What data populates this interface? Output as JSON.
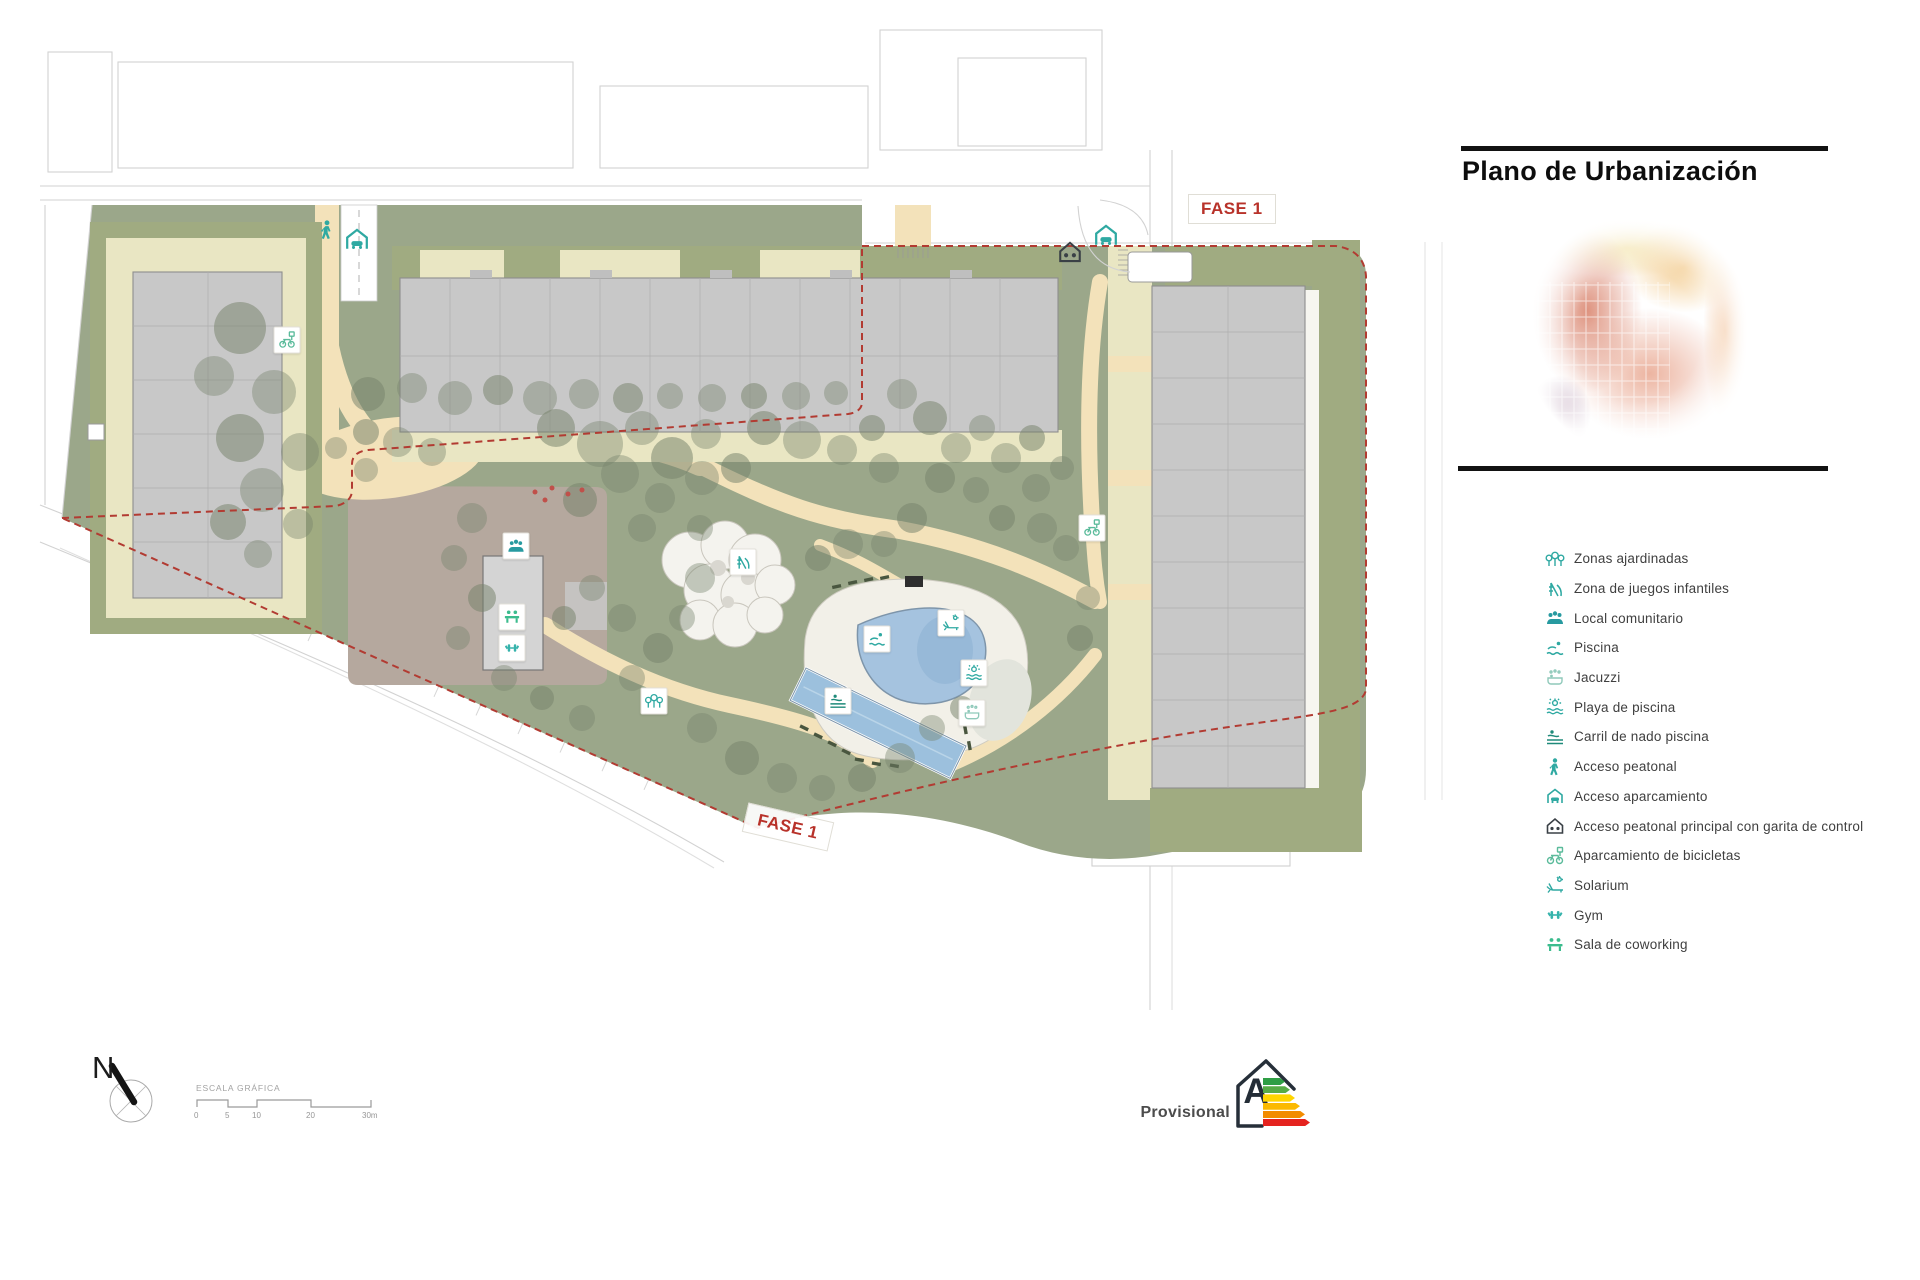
{
  "header": {
    "title": "Plano de Urbanización"
  },
  "plan": {
    "phase_labels": [
      {
        "text": "FASE 1"
      },
      {
        "text": "FASE 1"
      }
    ],
    "markers": [
      {
        "icon": "pedestrian-icon",
        "x": 327,
        "y": 230,
        "boxed": false,
        "size": 22,
        "color": "#2fa9a2"
      },
      {
        "icon": "parking-access-icon",
        "x": 357,
        "y": 239,
        "boxed": false,
        "size": 28,
        "color": "#2fa9a2"
      },
      {
        "icon": "main-access-icon",
        "x": 1070,
        "y": 252,
        "boxed": false,
        "size": 26,
        "color": "#3a4046"
      },
      {
        "icon": "parking-access-icon",
        "x": 1106,
        "y": 235,
        "boxed": false,
        "size": 28,
        "color": "#2fa9a2"
      },
      {
        "icon": "bike-parking-icon",
        "x": 287,
        "y": 340,
        "boxed": true,
        "size": 19,
        "color": "#5bbb9b"
      },
      {
        "icon": "community-icon",
        "x": 516,
        "y": 546,
        "boxed": true,
        "size": 19,
        "color": "#279aa0"
      },
      {
        "icon": "coworking-icon",
        "x": 512,
        "y": 617,
        "boxed": true,
        "size": 19,
        "color": "#3cbc8e"
      },
      {
        "icon": "gym-icon",
        "x": 512,
        "y": 648,
        "boxed": true,
        "size": 19,
        "color": "#36b3ac"
      },
      {
        "icon": "playground-icon",
        "x": 743,
        "y": 562,
        "boxed": true,
        "size": 19,
        "color": "#2fa9a2"
      },
      {
        "icon": "trees-icon",
        "x": 654,
        "y": 701,
        "boxed": true,
        "size": 19,
        "color": "#2fa9a2"
      },
      {
        "icon": "pool-icon",
        "x": 877,
        "y": 639,
        "boxed": true,
        "size": 19,
        "color": "#2fa9a2"
      },
      {
        "icon": "solarium-icon",
        "x": 951,
        "y": 623,
        "boxed": true,
        "size": 19,
        "color": "#2fa9a2"
      },
      {
        "icon": "pool-beach-icon",
        "x": 974,
        "y": 673,
        "boxed": true,
        "size": 19,
        "color": "#2fa9a2"
      },
      {
        "icon": "jacuzzi-icon",
        "x": 972,
        "y": 713,
        "boxed": true,
        "size": 19,
        "color": "#8fc9ba"
      },
      {
        "icon": "swim-lane-icon",
        "x": 838,
        "y": 701,
        "boxed": true,
        "size": 19,
        "color": "#1f8a7a"
      },
      {
        "icon": "bike-parking-icon",
        "x": 1092,
        "y": 528,
        "boxed": true,
        "size": 19,
        "color": "#5bbb9b"
      }
    ]
  },
  "legend": {
    "items": [
      {
        "icon": "trees-icon",
        "label": "Zonas ajardinadas",
        "color": "#2fa9a2"
      },
      {
        "icon": "playground-icon",
        "label": "Zona de juegos infantiles",
        "color": "#2fa9a2"
      },
      {
        "icon": "community-icon",
        "label": "Local comunitario",
        "color": "#279aa0"
      },
      {
        "icon": "pool-icon",
        "label": "Piscina",
        "color": "#2fa9a2"
      },
      {
        "icon": "jacuzzi-icon",
        "label": "Jacuzzi",
        "color": "#8fc9ba"
      },
      {
        "icon": "pool-beach-icon",
        "label": "Playa de piscina",
        "color": "#2fa9a2"
      },
      {
        "icon": "swim-lane-icon",
        "label": "Carril de nado piscina",
        "color": "#1f8a7a"
      },
      {
        "icon": "pedestrian-icon",
        "label": "Acceso peatonal",
        "color": "#2fa9a2"
      },
      {
        "icon": "parking-access-icon",
        "label": "Acceso aparcamiento",
        "color": "#2fa9a2"
      },
      {
        "icon": "main-access-icon",
        "label": "Acceso peatonal principal con garita de control",
        "color": "#3a4046"
      },
      {
        "icon": "bike-parking-icon",
        "label": "Aparcamiento de bicicletas",
        "color": "#5bbb9b"
      },
      {
        "icon": "solarium-icon",
        "label": "Solarium",
        "color": "#2fa9a2"
      },
      {
        "icon": "gym-icon",
        "label": "Gym",
        "color": "#36b3ac"
      },
      {
        "icon": "coworking-icon",
        "label": "Sala de coworking",
        "color": "#3cbc8e"
      }
    ]
  },
  "compass": {
    "letter": "N"
  },
  "scale_bar": {
    "label": "ESCALA GRÁFICA",
    "ticks": [
      "0",
      "5",
      "10",
      "20",
      "30m"
    ]
  },
  "energy_label": {
    "text": "Provisional",
    "rating": "A",
    "bar_colors": [
      "#2f9e45",
      "#57ab46",
      "#ffd500",
      "#fbb900",
      "#f28c00",
      "#e5231f"
    ]
  },
  "colors": {
    "accent_red": "#b8322a",
    "icon_teal": "#2fa9a2",
    "site_green": "#9ba78a",
    "path_beige": "#f3e2ba",
    "building_gray": "#c8c8c8",
    "pool_blue": "#a5c3df",
    "boundary_red": "#b23b32",
    "olive_band": "#a0ab81",
    "pale_band": "#e9e6c3",
    "paved_mauve": "#b5a89e",
    "tree_green": "#76836b"
  }
}
